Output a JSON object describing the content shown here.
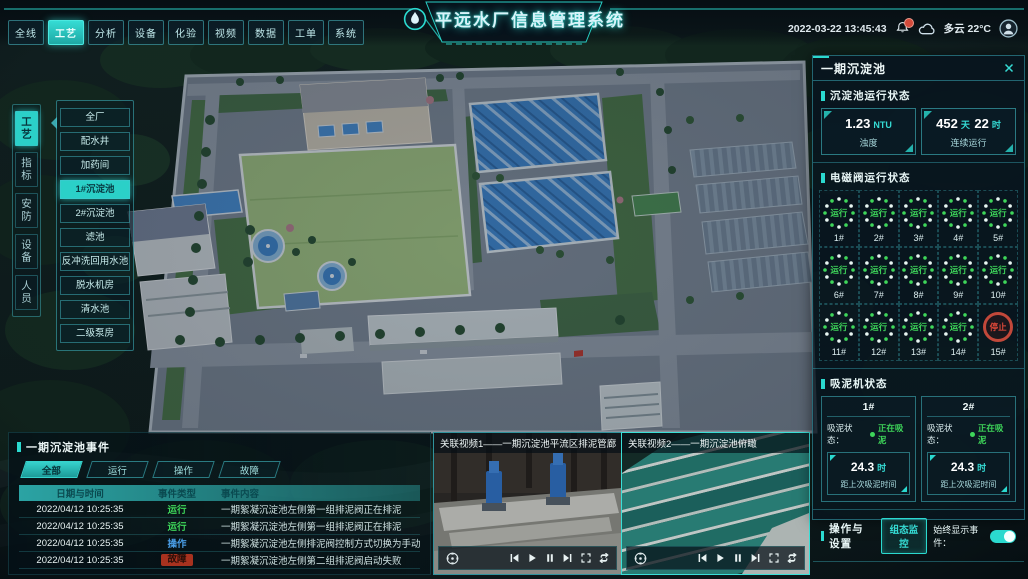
{
  "header": {
    "title": "平远水厂信息管理系统",
    "tabs": [
      {
        "label": "全线"
      },
      {
        "label": "工艺"
      },
      {
        "label": "分析"
      },
      {
        "label": "设备"
      },
      {
        "label": "化验"
      },
      {
        "label": "视频"
      },
      {
        "label": "数据"
      },
      {
        "label": "工单"
      },
      {
        "label": "系统"
      }
    ],
    "active_tab": "工艺",
    "datetime": "2022-03-22 13:45:43",
    "weather": "多云 22°C",
    "icons": {
      "logo": "water-drop",
      "bell": "bell",
      "badge": "red-dot",
      "cloud": "cloud",
      "avatar": "user"
    }
  },
  "sidebar": {
    "tabs": [
      {
        "label": "工艺"
      },
      {
        "label": "指标"
      },
      {
        "label": "安防"
      },
      {
        "label": "设备"
      },
      {
        "label": "人员"
      }
    ],
    "active_tab": "工艺",
    "submenu": [
      {
        "label": "全厂"
      },
      {
        "label": "配水井"
      },
      {
        "label": "加药间"
      },
      {
        "label": "1#沉淀池"
      },
      {
        "label": "2#沉淀池"
      },
      {
        "label": "滤池"
      },
      {
        "label": "反冲洗回用水池"
      },
      {
        "label": "脱水机房"
      },
      {
        "label": "清水池"
      },
      {
        "label": "二级泵房"
      }
    ],
    "active_submenu": "1#沉淀池"
  },
  "right_panel": {
    "title": "一期沉淀池",
    "run_status": {
      "title": "沉淀池运行状态",
      "stats": [
        {
          "value": "1.23",
          "unit": "NTU",
          "label": "浊度"
        },
        {
          "parts": [
            {
              "v": "452",
              "u": "天"
            },
            {
              "v": "22",
              "u": "时"
            }
          ],
          "label": "连续运行"
        }
      ]
    },
    "valves": {
      "title": "电磁阀运行状态",
      "items": [
        {
          "id": "1#",
          "status": "运行"
        },
        {
          "id": "2#",
          "status": "运行"
        },
        {
          "id": "3#",
          "status": "运行"
        },
        {
          "id": "4#",
          "status": "运行"
        },
        {
          "id": "5#",
          "status": "运行"
        },
        {
          "id": "6#",
          "status": "运行"
        },
        {
          "id": "7#",
          "status": "运行"
        },
        {
          "id": "8#",
          "status": "运行"
        },
        {
          "id": "9#",
          "status": "运行"
        },
        {
          "id": "10#",
          "status": "运行"
        },
        {
          "id": "11#",
          "status": "运行"
        },
        {
          "id": "12#",
          "status": "运行"
        },
        {
          "id": "13#",
          "status": "运行"
        },
        {
          "id": "14#",
          "status": "运行"
        },
        {
          "id": "15#",
          "status": "停止"
        }
      ]
    },
    "mud": {
      "title": "吸泥机状态",
      "machines": [
        {
          "id": "1#",
          "status_label": "吸泥状态：",
          "status": "正在吸泥",
          "value": "24.3",
          "unit": "时",
          "label": "距上次吸泥时间"
        },
        {
          "id": "2#",
          "status_label": "吸泥状态：",
          "status": "正在吸泥",
          "value": "24.3",
          "unit": "时",
          "label": "距上次吸泥时间"
        }
      ]
    },
    "ops": {
      "title": "操作与设置",
      "button": "组态监控",
      "toggle_label": "始终显示事件：",
      "toggle_on": true
    }
  },
  "events": {
    "title": "一期沉淀池事件",
    "tabs": [
      {
        "label": "全部"
      },
      {
        "label": "运行"
      },
      {
        "label": "操作"
      },
      {
        "label": "故障"
      }
    ],
    "active_tab": "全部",
    "columns": [
      "日期与时间",
      "事件类型",
      "事件内容"
    ],
    "rows": [
      {
        "time": "2022/04/12 10:25:35",
        "type": "运行",
        "content": "一期絮凝沉淀池左侧第一组排泥阀正在排泥"
      },
      {
        "time": "2022/04/12 10:25:35",
        "type": "运行",
        "content": "一期絮凝沉淀池左侧第一组排泥阀正在排泥"
      },
      {
        "time": "2022/04/12 10:25:35",
        "type": "操作",
        "content": "一期絮凝沉淀池左侧排泥阀控制方式切换为手动"
      },
      {
        "time": "2022/04/12 10:25:35",
        "type": "故障",
        "content": "一期絮凝沉淀池左侧第二组排泥阀启动失败"
      }
    ]
  },
  "videos": [
    {
      "title": "关联视频1——一期沉淀池平流区排泥管廊"
    },
    {
      "title": "关联视频2——一期沉淀池俯瞰"
    }
  ],
  "video_icons": [
    "ptz-dpad",
    "skip-back",
    "play",
    "pause",
    "skip-forward",
    "fullscreen",
    "loop"
  ],
  "colors": {
    "accent": "#2BD9CF",
    "green": "#3ED65A",
    "red": "#E0493A",
    "blue": "#4A9FE8"
  }
}
